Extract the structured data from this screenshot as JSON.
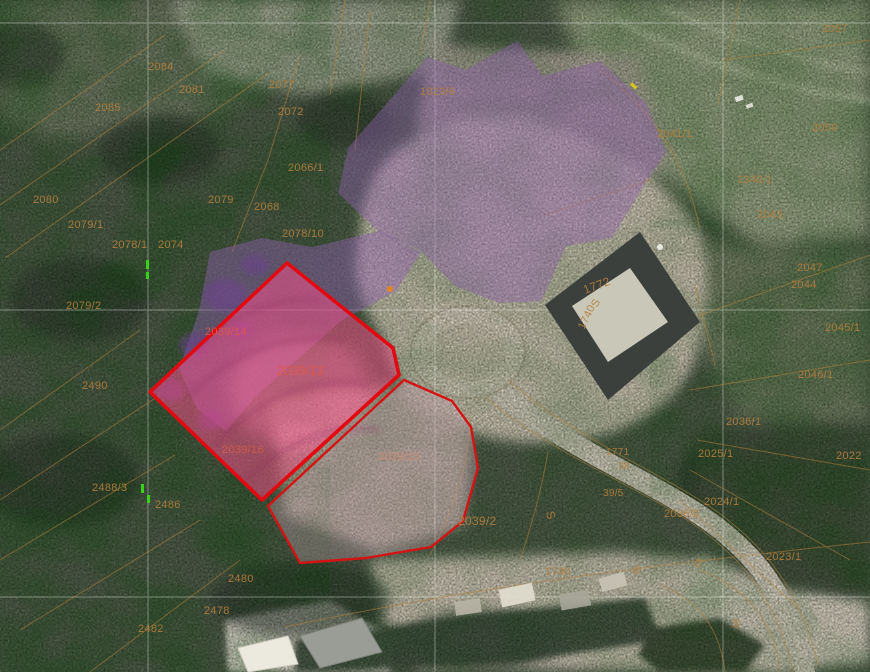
{
  "app": {
    "view": "cadastral-aerial-map"
  },
  "colors": {
    "selection_red": "#e20a10",
    "neighbor_red": "#d41414",
    "overlay_purple": "#8f5fae",
    "overlay_pink": "#ff4f8e",
    "cadastral_line_orange": "#b5823c",
    "label_default": "#b57f3e",
    "label_red": "#e25847",
    "survey_grid_white": "#ffffff",
    "green_mark": "#35d217"
  },
  "labels": [
    {
      "text": "2084",
      "x": 148,
      "y": 70
    },
    {
      "text": "2081",
      "x": 179,
      "y": 93
    },
    {
      "text": "2085",
      "x": 95,
      "y": 111
    },
    {
      "text": "2077",
      "x": 269,
      "y": 88
    },
    {
      "text": "2072",
      "x": 278,
      "y": 115
    },
    {
      "text": "2066/1",
      "x": 288,
      "y": 171
    },
    {
      "text": "1023/6",
      "x": 420,
      "y": 95
    },
    {
      "text": "2080",
      "x": 33,
      "y": 203
    },
    {
      "text": "2079",
      "x": 208,
      "y": 203
    },
    {
      "text": "2068",
      "x": 254,
      "y": 210
    },
    {
      "text": "2078/10",
      "x": 282,
      "y": 237
    },
    {
      "text": "2079/1",
      "x": 68,
      "y": 228
    },
    {
      "text": "2078/1",
      "x": 112,
      "y": 248
    },
    {
      "text": "2074",
      "x": 158,
      "y": 248
    },
    {
      "text": "2079/2",
      "x": 66,
      "y": 309
    },
    {
      "text": "2490",
      "x": 82,
      "y": 389
    },
    {
      "text": "2488/3",
      "x": 92,
      "y": 491
    },
    {
      "text": "2486",
      "x": 155,
      "y": 508
    },
    {
      "text": "2480",
      "x": 228,
      "y": 582
    },
    {
      "text": "2478",
      "x": 204,
      "y": 614
    },
    {
      "text": "2482",
      "x": 138,
      "y": 632
    },
    {
      "text": "2039/14",
      "x": 205,
      "y": 335,
      "color": "#e25847"
    },
    {
      "text": "2039/13",
      "x": 277,
      "y": 375,
      "color": "#e25847",
      "size": 12.5
    },
    {
      "text": "2039/16",
      "x": 222,
      "y": 453,
      "color": "#d2604a"
    },
    {
      "text": "2039/15",
      "x": 378,
      "y": 460,
      "color": "#c98a70"
    },
    {
      "text": "2039/2",
      "x": 458,
      "y": 525,
      "size": 12
    },
    {
      "text": "1772",
      "x": 585,
      "y": 294,
      "rot": -20,
      "size": 12
    },
    {
      "text": "S",
      "x": 597,
      "y": 308,
      "rot": -62
    },
    {
      "text": "1740",
      "x": 584,
      "y": 330,
      "rot": -64
    },
    {
      "text": "1771",
      "x": 606,
      "y": 455,
      "size": 10
    },
    {
      "text": "38",
      "x": 618,
      "y": 469,
      "size": 10
    },
    {
      "text": "39/5",
      "x": 603,
      "y": 496,
      "size": 10
    },
    {
      "text": "1740",
      "x": 545,
      "y": 575
    },
    {
      "text": "S",
      "x": 546,
      "y": 512,
      "rot": 78,
      "size": 12
    },
    {
      "text": "S",
      "x": 631,
      "y": 571,
      "rot": 35,
      "size": 12
    },
    {
      "text": "S",
      "x": 693,
      "y": 564,
      "rot": 35,
      "size": 12
    },
    {
      "text": "S",
      "x": 731,
      "y": 626,
      "rot": 20,
      "size": 12
    },
    {
      "text": "2036/1",
      "x": 726,
      "y": 425
    },
    {
      "text": "2025/1",
      "x": 698,
      "y": 457
    },
    {
      "text": "2022",
      "x": 836,
      "y": 459
    },
    {
      "text": "2024/1",
      "x": 704,
      "y": 505
    },
    {
      "text": "2036/2",
      "x": 664,
      "y": 517
    },
    {
      "text": "2023/1",
      "x": 766,
      "y": 560
    },
    {
      "text": "2045/1",
      "x": 825,
      "y": 331
    },
    {
      "text": "2046/1",
      "x": 798,
      "y": 378
    },
    {
      "text": "2050",
      "x": 812,
      "y": 131
    },
    {
      "text": "1340/1",
      "x": 737,
      "y": 183
    },
    {
      "text": "2043",
      "x": 757,
      "y": 218
    },
    {
      "text": "2047",
      "x": 797,
      "y": 271
    },
    {
      "text": "2044",
      "x": 791,
      "y": 288
    },
    {
      "text": "2057",
      "x": 822,
      "y": 32
    },
    {
      "text": "2041/1",
      "x": 657,
      "y": 137
    }
  ]
}
